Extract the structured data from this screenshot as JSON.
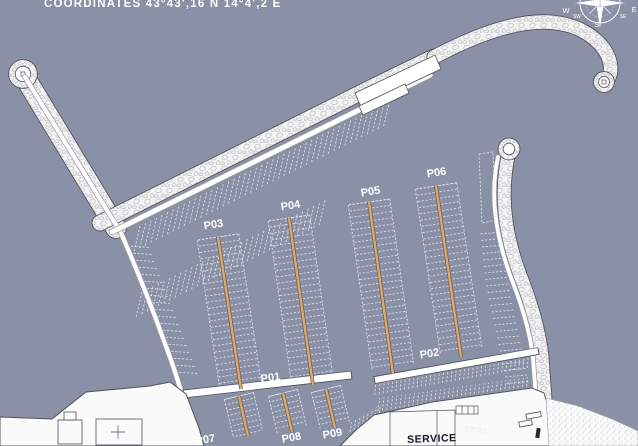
{
  "title": {
    "text": "COORDINATES 43°43',16 N 14°4',2 E"
  },
  "compass": {
    "w": "W",
    "e": "E",
    "s": "S",
    "sw": "SW",
    "se": "SE"
  },
  "piers": {
    "p01": "P01",
    "p02": "P02",
    "p03": "P03",
    "p04": "P04",
    "p05": "P05",
    "p06": "P06",
    "p07": "P07",
    "p08": "P08",
    "p09": "P09"
  },
  "service": {
    "label": "SERVICE"
  },
  "colors": {
    "water": "#8A90A6",
    "land": "#FAFAFB",
    "rock_fill": "#F3F3F4",
    "rock_stone": "#BFBFC6",
    "outline": "#52525A",
    "road": "#FFFFFF",
    "road_casing": "#9B9BA2",
    "pier": "#DCA96E",
    "pier_outline": "#6B5B45",
    "berth_dash": "#E3E7EF",
    "label": "#FFFFFF",
    "service_text": "#15152B"
  }
}
